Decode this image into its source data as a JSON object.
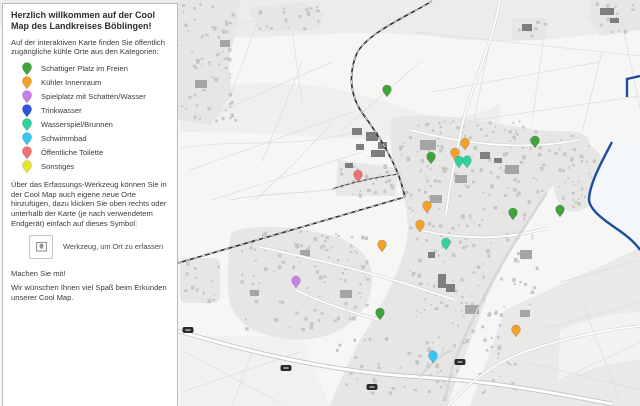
{
  "panel": {
    "title": "Herzlich willkommen auf der Cool Map des Landkreises Böblingen!",
    "intro": "Auf der interaktiven Karte finden Sie öffentlich zugängliche kühle Orte aus den Kategorien:",
    "tool_info": "Über das Erfassungs-Werkzeug können Sie in der Cool Map auch eigene neue Orte hinzufügen, dazu klicken Sie oben rechts oder unterhalb der Karte (je nach verwendetem Endgerät) einfach auf dieses Symbol:",
    "tool_button_label": "Werkzeug, um Ort zu erfassen",
    "cta": "Machen Sie mit!",
    "outro": "Wir wünschen Ihnen viel Spaß beim Erkunden unserer Cool Map."
  },
  "legend": {
    "items": [
      {
        "key": "schattiger-platz",
        "label": "Schattiger Platz im Freien",
        "color": "#3fa43c"
      },
      {
        "key": "kuehler-innenraum",
        "label": "Kühler Innenraum",
        "color": "#f2a12b"
      },
      {
        "key": "spielplatz",
        "label": "Spielplatz mit Schatten/Wasser",
        "color": "#c67fe4"
      },
      {
        "key": "trinkwasser",
        "label": "Trinkwasser",
        "color": "#2d55d4"
      },
      {
        "key": "wasserspiel",
        "label": "Wasserspiel/Brunnen",
        "color": "#2fd39b"
      },
      {
        "key": "schwimmbad",
        "label": "Schwimmbad",
        "color": "#3ac4f0"
      },
      {
        "key": "toilette",
        "label": "Öffentliche Toilette",
        "color": "#ef7170"
      },
      {
        "key": "sonstiges",
        "label": "Sonstiges",
        "color": "#e5e531"
      }
    ]
  },
  "map": {
    "water_color": "#1d4e9e",
    "markers": [
      {
        "category": "schattiger-platz",
        "x": 387,
        "y": 97
      },
      {
        "category": "toilette",
        "x": 358,
        "y": 182
      },
      {
        "category": "kuehler-innenraum",
        "x": 465,
        "y": 150
      },
      {
        "category": "kuehler-innenraum",
        "x": 455,
        "y": 160
      },
      {
        "category": "wasserspiel",
        "x": 459,
        "y": 168
      },
      {
        "category": "wasserspiel",
        "x": 467,
        "y": 168
      },
      {
        "category": "schattiger-platz",
        "x": 431,
        "y": 164
      },
      {
        "category": "schattiger-platz",
        "x": 535,
        "y": 148
      },
      {
        "category": "kuehler-innenraum",
        "x": 427,
        "y": 213
      },
      {
        "category": "kuehler-innenraum",
        "x": 420,
        "y": 232
      },
      {
        "category": "wasserspiel",
        "x": 446,
        "y": 250
      },
      {
        "category": "schattiger-platz",
        "x": 513,
        "y": 220
      },
      {
        "category": "schattiger-platz",
        "x": 560,
        "y": 217
      },
      {
        "category": "spielplatz",
        "x": 296,
        "y": 288
      },
      {
        "category": "kuehler-innenraum",
        "x": 382,
        "y": 252
      },
      {
        "category": "schattiger-platz",
        "x": 380,
        "y": 320
      },
      {
        "category": "kuehler-innenraum",
        "x": 516,
        "y": 337
      },
      {
        "category": "schwimmbad",
        "x": 433,
        "y": 363
      }
    ]
  }
}
